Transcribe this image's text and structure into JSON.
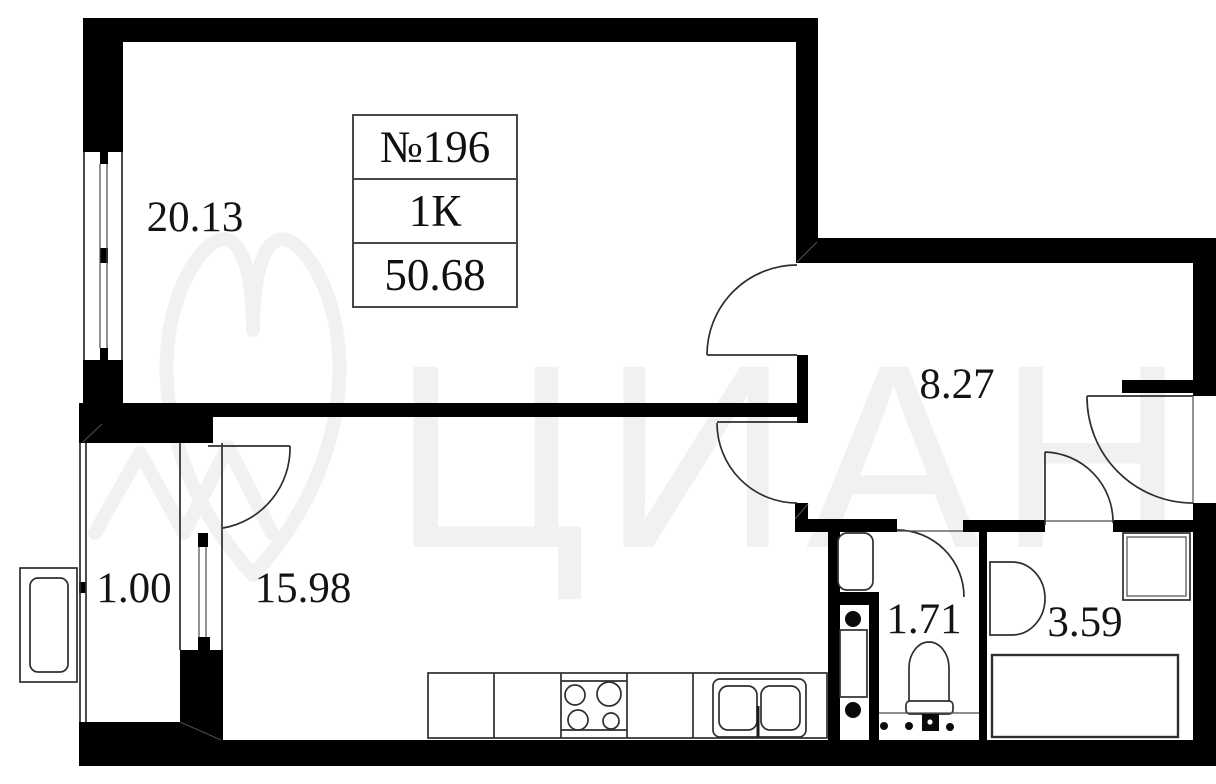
{
  "title": "Apartment floor plan",
  "info_box": {
    "apartment_number": "№196",
    "room_type": "1К",
    "total_area": "50.68"
  },
  "rooms": [
    {
      "id": "living-room",
      "area_label": "20.13"
    },
    {
      "id": "balcony",
      "area_label": "1.00"
    },
    {
      "id": "kitchen-living",
      "area_label": "15.98"
    },
    {
      "id": "hallway",
      "area_label": "8.27"
    },
    {
      "id": "wc",
      "area_label": "1.71"
    },
    {
      "id": "bathroom",
      "area_label": "3.59"
    }
  ],
  "watermark": {
    "text": "ЦИАН"
  },
  "colors": {
    "wall": "#000000",
    "line": "#2e2e2e",
    "text": "#141414",
    "watermark": "#f1f1f1",
    "background": "#ffffff"
  }
}
